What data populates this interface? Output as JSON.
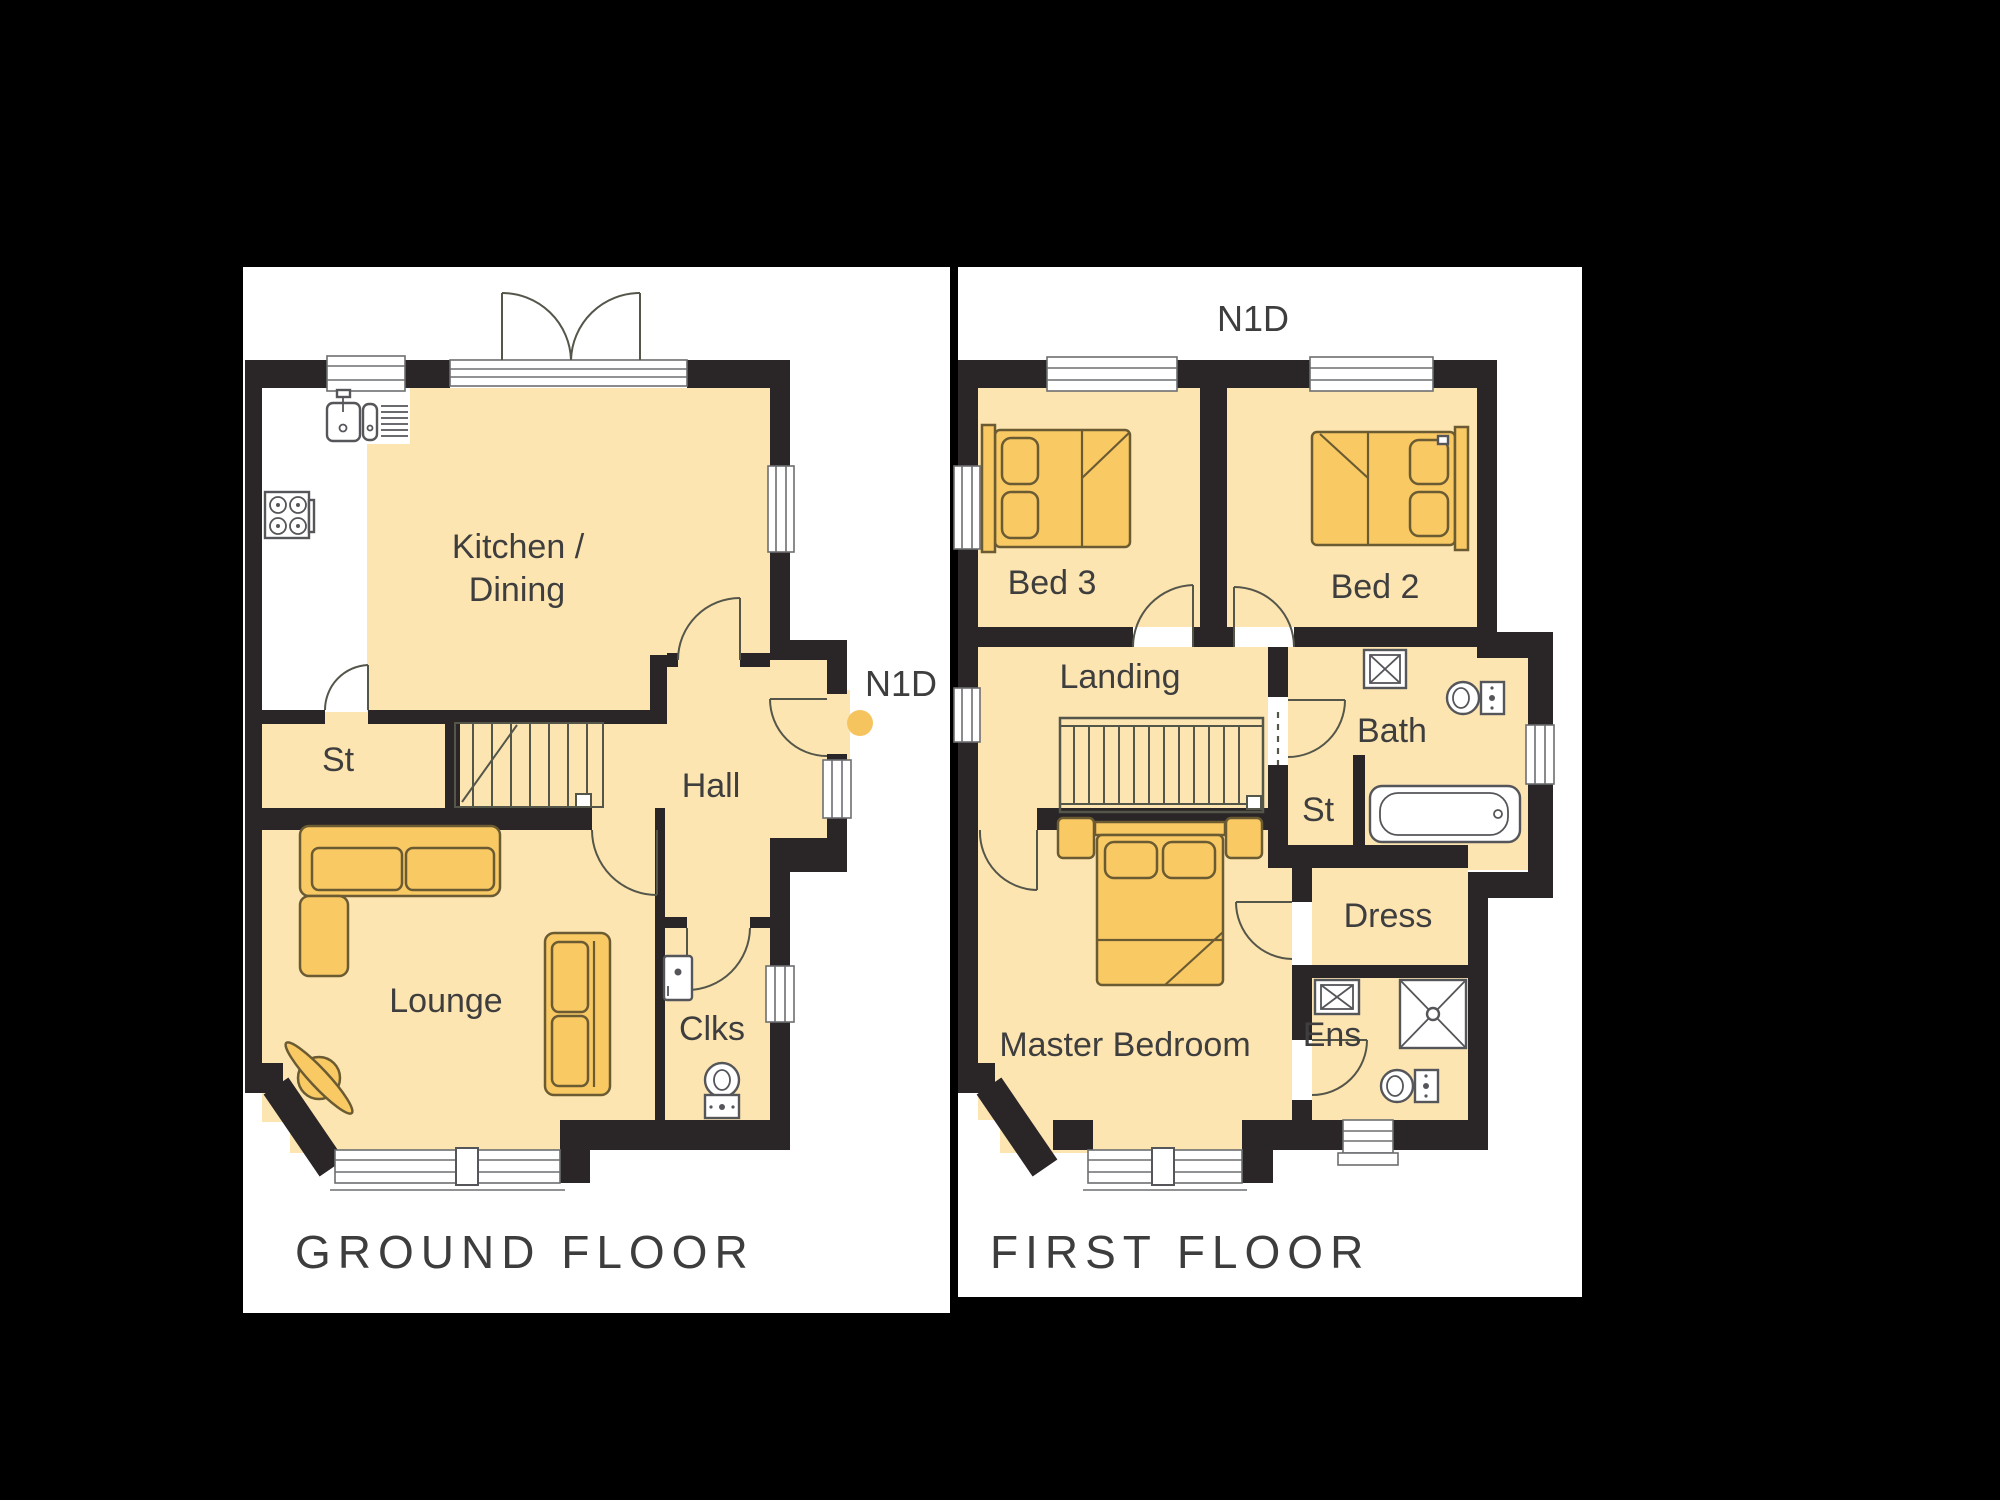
{
  "document": {
    "type": "floorplan",
    "plot_code": "N1D",
    "background_color": "#000000",
    "panel_color": "#ffffff",
    "wall_color": "#2a2526",
    "floor_fill_color": "#fde5b2",
    "furniture_fill_color": "#f9c964",
    "marker_dot_color": "#f6c45f",
    "text_color": "#3e3e3e"
  },
  "ground_floor": {
    "caption": "GROUND FLOOR",
    "marker_label": "N1D",
    "rooms": [
      {
        "id": "kitchen_dining",
        "label_line1": "Kitchen /",
        "label_line2": "Dining"
      },
      {
        "id": "store",
        "label": "St"
      },
      {
        "id": "hall",
        "label": "Hall"
      },
      {
        "id": "lounge",
        "label": "Lounge"
      },
      {
        "id": "cloakroom",
        "label": "Clks"
      }
    ]
  },
  "first_floor": {
    "caption": "FIRST FLOOR",
    "marker_label": "N1D",
    "rooms": [
      {
        "id": "bed3",
        "label": "Bed 3"
      },
      {
        "id": "bed2",
        "label": "Bed 2"
      },
      {
        "id": "landing",
        "label": "Landing"
      },
      {
        "id": "bath",
        "label": "Bath"
      },
      {
        "id": "store",
        "label": "St"
      },
      {
        "id": "dress",
        "label": "Dress"
      },
      {
        "id": "master_bedroom",
        "label": "Master Bedroom"
      },
      {
        "id": "ensuite",
        "label": "Ens"
      }
    ]
  }
}
